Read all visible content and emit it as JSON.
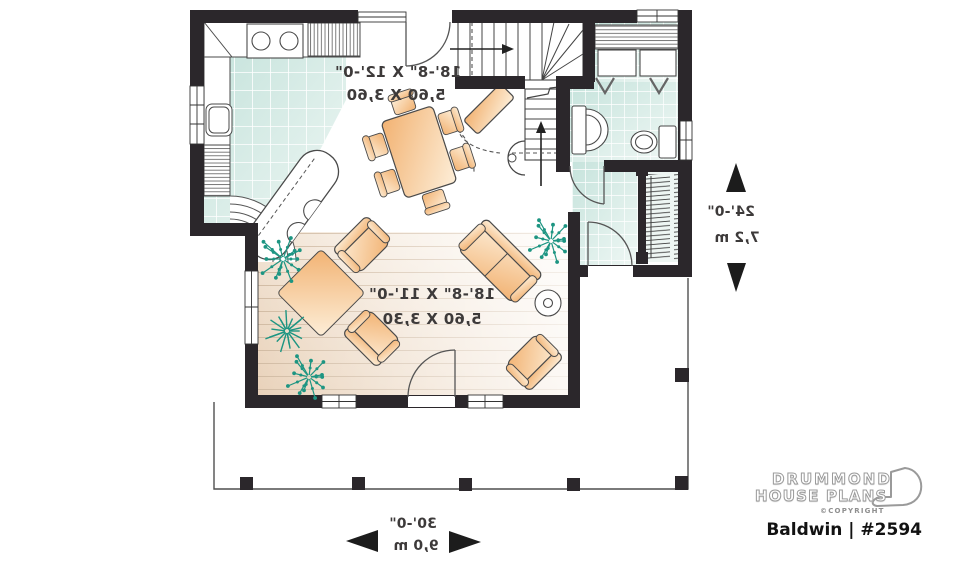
{
  "floorplan": {
    "rooms": {
      "kitchen_dining": {
        "imperial": "18'-8\" X 12'-0\"",
        "metric": "5,60 X 3,60"
      },
      "living": {
        "imperial": "18'-8\" X 11'-0\"",
        "metric": "5,60 X 3,30"
      }
    },
    "overall": {
      "depth": {
        "imperial": "24'-0\"",
        "metric": "7,2 m"
      },
      "width": {
        "imperial": "30'-0\"",
        "metric": "9,0 m"
      }
    }
  },
  "branding": {
    "name_line1": "DRUMMOND",
    "name_line2": "HOUSE PLANS",
    "copyright": "©COPYRIGHT",
    "plan_title": "Baldwin | #2594"
  },
  "colors": {
    "wall": "#2b272b",
    "tile": "#cde7e0",
    "wood": "#ead5c0",
    "furniture": "#f3b67a",
    "plant": "#1d9582",
    "porch_line": "#4f4f4f"
  }
}
